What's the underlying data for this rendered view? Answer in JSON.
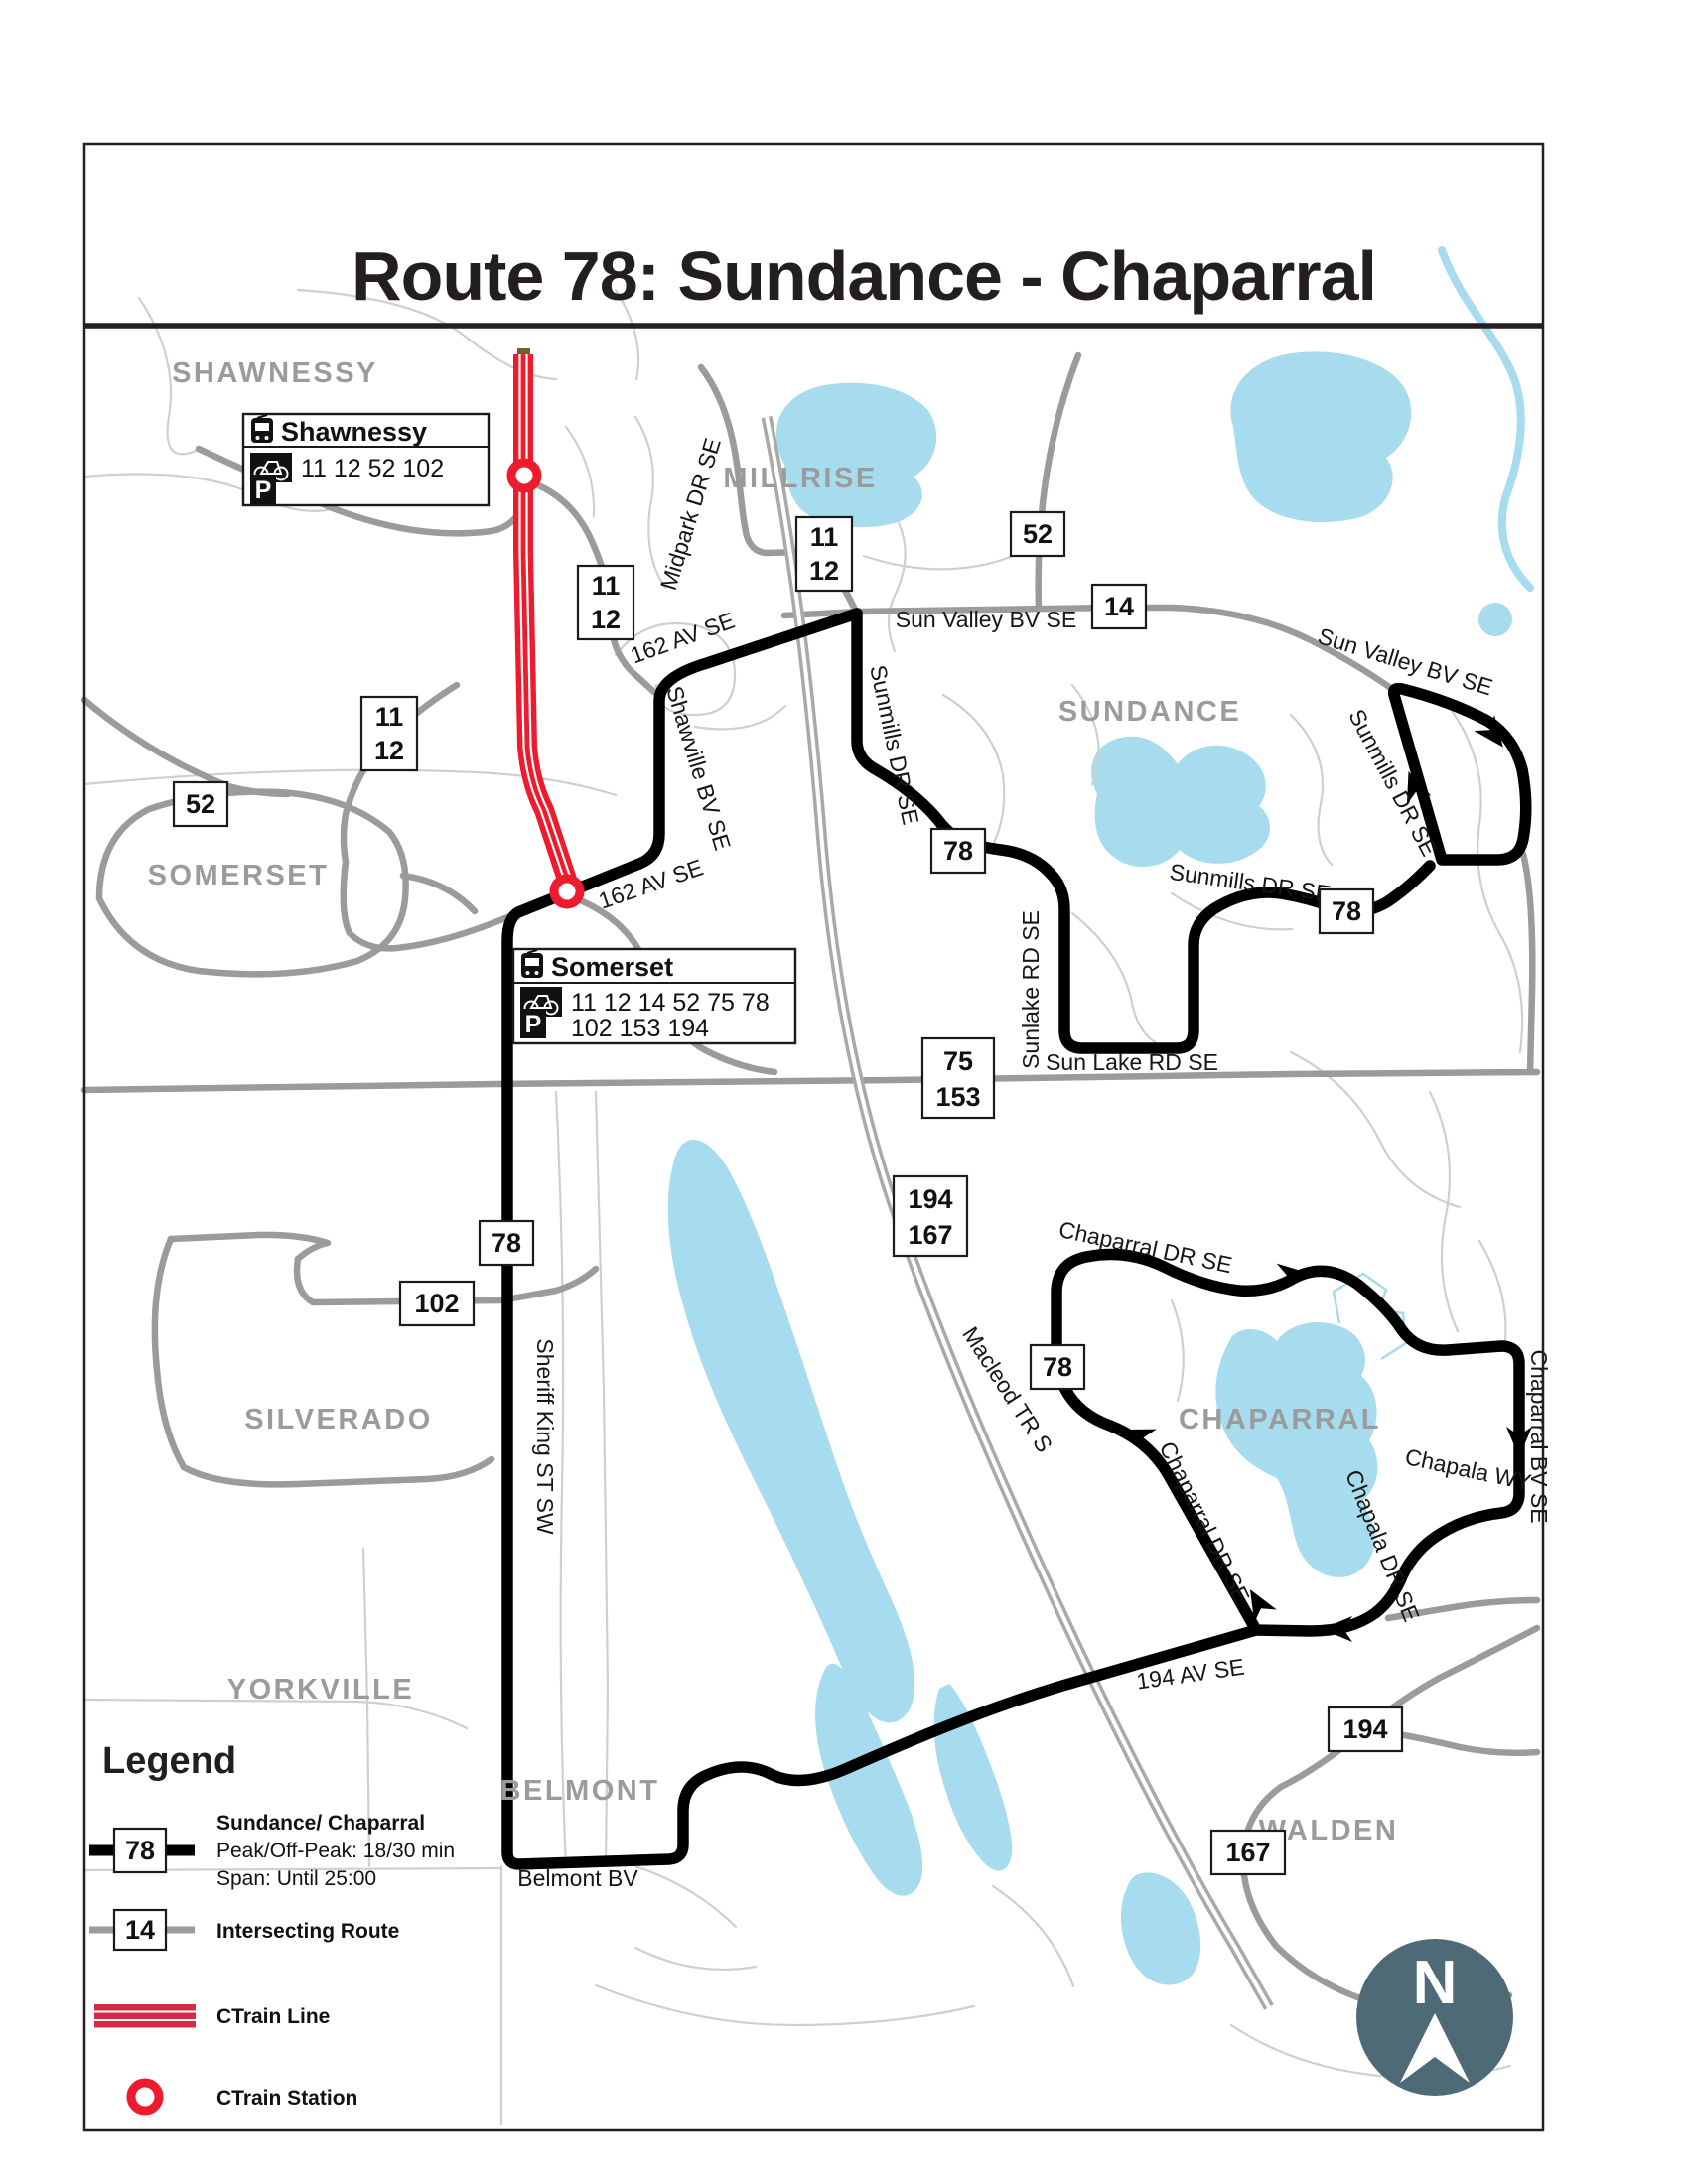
{
  "page": {
    "title": "Route 78: Sundance - Chaparral"
  },
  "colors": {
    "route_black": "#000000",
    "intersecting_gray": "#9b9b9b",
    "ctrain_red": "#ee1b2e",
    "legend_band_red": "#d52b47",
    "water_blue": "#a6dcee",
    "neighborhood_gray": "#9b9b9b",
    "compass_bg": "#4d6a76"
  },
  "callouts": {
    "shawnessy": {
      "title": "Shawnessy",
      "bike_routes": "11 12 52 102",
      "park_routes": ""
    },
    "somerset": {
      "title": "Somerset",
      "bike_routes": "11 12 14 52 75 78",
      "park_routes": "102 153 194"
    }
  },
  "neighborhoods": [
    {
      "label": "SHAWNESSY"
    },
    {
      "label": "MILLRISE"
    },
    {
      "label": "SUNDANCE"
    },
    {
      "label": "SOMERSET"
    },
    {
      "label": "SILVERADO"
    },
    {
      "label": "CHAPARRAL"
    },
    {
      "label": "YORKVILLE"
    },
    {
      "label": "BELMONT"
    },
    {
      "label": "WALDEN"
    }
  ],
  "streets": [
    {
      "label": "162 AV SE"
    },
    {
      "label": "162 AV SE"
    },
    {
      "label": "Shawville BV SE"
    },
    {
      "label": "Midpark DR SE"
    },
    {
      "label": "Sun Valley BV SE"
    },
    {
      "label": "Sun Valley BV SE"
    },
    {
      "label": "Sunmills DR SE"
    },
    {
      "label": "Sunmills DR SE"
    },
    {
      "label": "Sunmills DR SE"
    },
    {
      "label": "Sunlake RD SE"
    },
    {
      "label": "Sun Lake RD SE"
    },
    {
      "label": "Macleod TR S"
    },
    {
      "label": "Chaparral DR SE"
    },
    {
      "label": "Chaparral DR SE"
    },
    {
      "label": "Chaparral BV SE"
    },
    {
      "label": "Chapala WY"
    },
    {
      "label": "Chapala DR SE"
    },
    {
      "label": "194 AV SE"
    },
    {
      "label": "Belmont BV"
    },
    {
      "label": "Sheriff King ST SW"
    }
  ],
  "badges": [
    {
      "lines": [
        "11",
        "12"
      ]
    },
    {
      "lines": [
        "11",
        "12"
      ]
    },
    {
      "lines": [
        "52"
      ]
    },
    {
      "lines": [
        "14"
      ]
    },
    {
      "lines": [
        "11",
        "12"
      ]
    },
    {
      "lines": [
        "52"
      ]
    },
    {
      "lines": [
        "78"
      ]
    },
    {
      "lines": [
        "78"
      ]
    },
    {
      "lines": [
        "75",
        "153"
      ]
    },
    {
      "lines": [
        "194",
        "167"
      ]
    },
    {
      "lines": [
        "78"
      ]
    },
    {
      "lines": [
        "102"
      ]
    },
    {
      "lines": [
        "78"
      ]
    },
    {
      "lines": [
        "194"
      ]
    },
    {
      "lines": [
        "167"
      ]
    }
  ],
  "legend": {
    "title": "Legend",
    "route_badge": "78",
    "route_name": "Sundance/ Chaparral",
    "route_peak": "Peak/Off-Peak: 18/30 min",
    "route_span": "Span: Until 25:00",
    "intersecting_badge": "14",
    "intersecting_label": "Intersecting Route",
    "ctrain_line_label": "CTrain Line",
    "ctrain_station_label": "CTrain Station"
  },
  "compass": {
    "label": "N"
  }
}
